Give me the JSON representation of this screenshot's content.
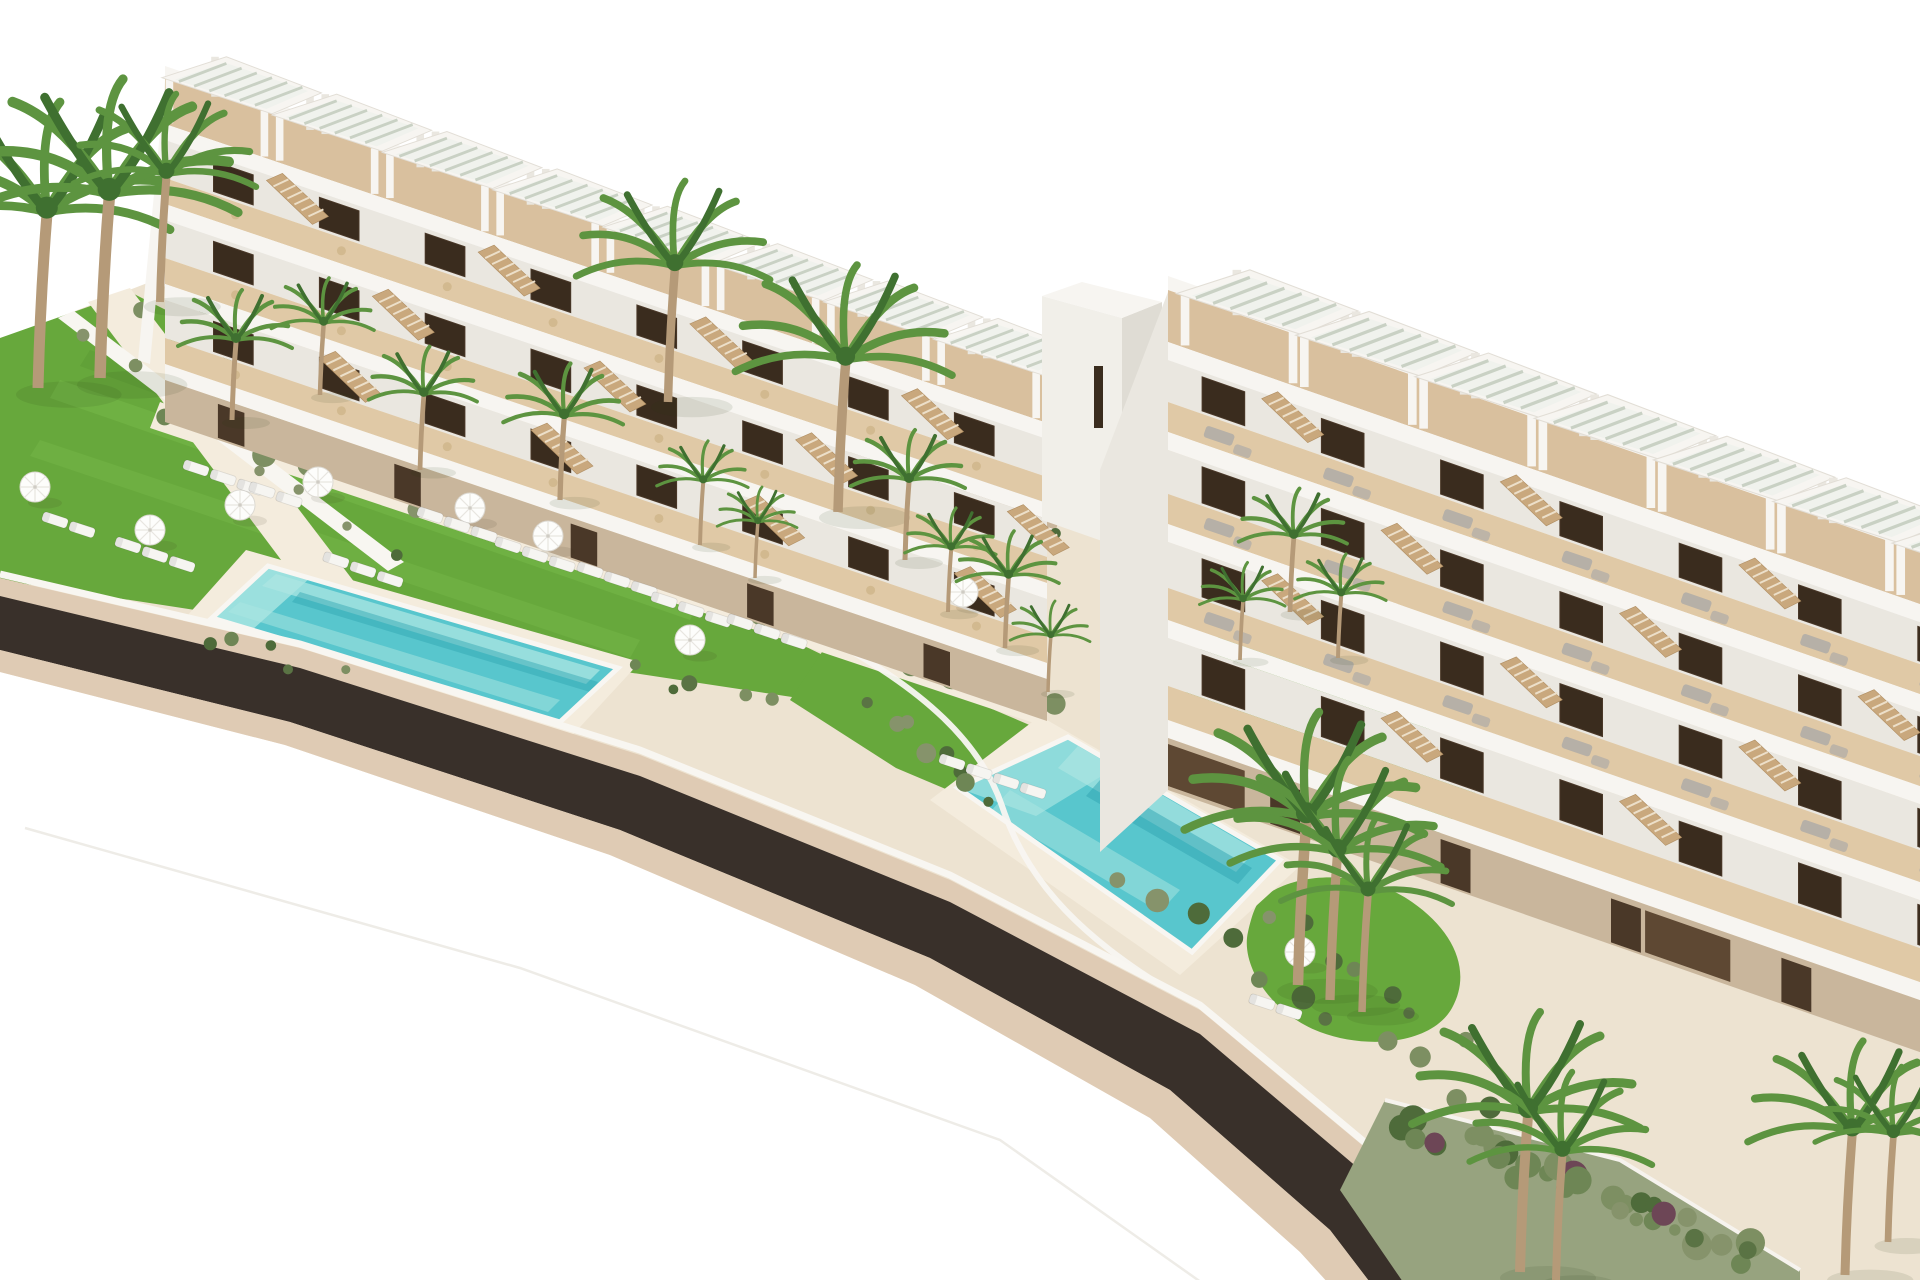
{
  "scene": {
    "type": "aerial-architectural-rendering",
    "description": "Aerial 3D architectural rendering of a modern white terraced apartment complex: two stepped residential blocks with rooftop pergolas and wooden roof decks, balconies with staircases, landscaped lawns with white parasols and sun loungers, two turquoise swimming pools, tropical palm trees and shrub gardens, and a dark curved road sweeping across the lower left on a pure white background.",
    "background": "#ffffff",
    "time_of_day": "daylight",
    "no_visible_text": true
  },
  "palette": {
    "bg": "#ffffff",
    "ground": "#ede3d1",
    "path-light": "#f4ecdd",
    "lawn": "#67a83c",
    "lawn-light": "#7cbd4e",
    "lawn-dark": "#4f8c2d",
    "scrub-base": "#97a37f",
    "palm": "#5d9440",
    "palm-dark": "#3f7030",
    "trunk": "#b59a78",
    "pool": "#58c6cd",
    "pool-light": "#ace6e2",
    "pool-dark": "#2fa3b1",
    "coping": "#f8f6f2",
    "road": "#39302a",
    "curb": "#dfcbb4",
    "parapet": "#f7f5f1",
    "building-shade": "#eae7e0",
    "roof-deck": "#d9c09e",
    "deck-wood": "#e0c9a6",
    "stone": "#c9b69c",
    "glass": "#3a2c1e",
    "door": "#4a3828",
    "wood-wall": "#5e4833",
    "stair-wood": "#c9a87d",
    "umbrella": "#fdfdfb",
    "lounger-white": "#f6f5f1",
    "lounger-gray": "#b6b0a7",
    "wall-white": "#f8f6f1",
    "tower-front": "#f1efe9",
    "tower-side": "#dfdcd4",
    "shrub-1": "#5a7344",
    "shrub-2": "#6e8655",
    "shrub-3": "#86936b",
    "shrub-4": "#4e6b3a",
    "shrub-5": "#7d8f62",
    "flower-accent": "#6d4656"
  },
  "objects": {
    "buildings": [
      {
        "name": "left-terraced-block",
        "style": "white stepped duplex block, 3 balcony levels, rooftop pergolas",
        "rooftop_pergolas": 8
      },
      {
        "name": "right-terraced-block",
        "style": "white stepped duplex block, 4 balcony levels, rooftop pergolas",
        "rooftop_pergolas": 7
      }
    ],
    "tower": {
      "name": "stair-core-tower",
      "feature": "tall white volume with slit window between the blocks"
    },
    "pools": [
      {
        "name": "left-pool",
        "shape": "long rectangle, rotated with site"
      },
      {
        "name": "central-pool",
        "shape": "long rectangle, rotated with site"
      }
    ],
    "road": {
      "name": "perimeter-road",
      "surface": "dark asphalt with beige curbs",
      "path": "curves from left edge to bottom right"
    },
    "counts": {
      "umbrellas": 9,
      "white_loungers": 34,
      "palm_trees": 25,
      "rooftop_pergolas": 15,
      "staircases": 26,
      "swimming_pools": 2
    }
  }
}
